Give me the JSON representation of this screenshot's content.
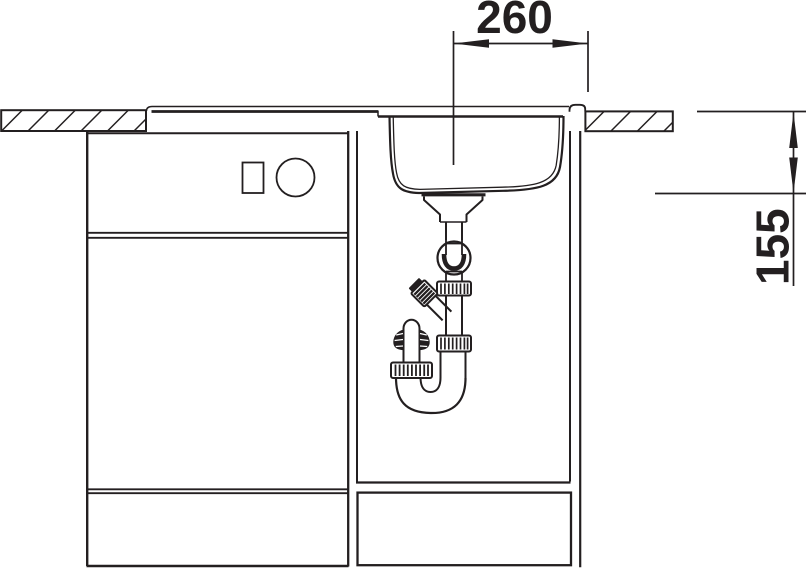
{
  "drawing": {
    "dimension_horizontal": {
      "label": "260"
    },
    "dimension_vertical": {
      "label": "155"
    },
    "line_color": "#231f20",
    "background_color": "#ffffff"
  }
}
